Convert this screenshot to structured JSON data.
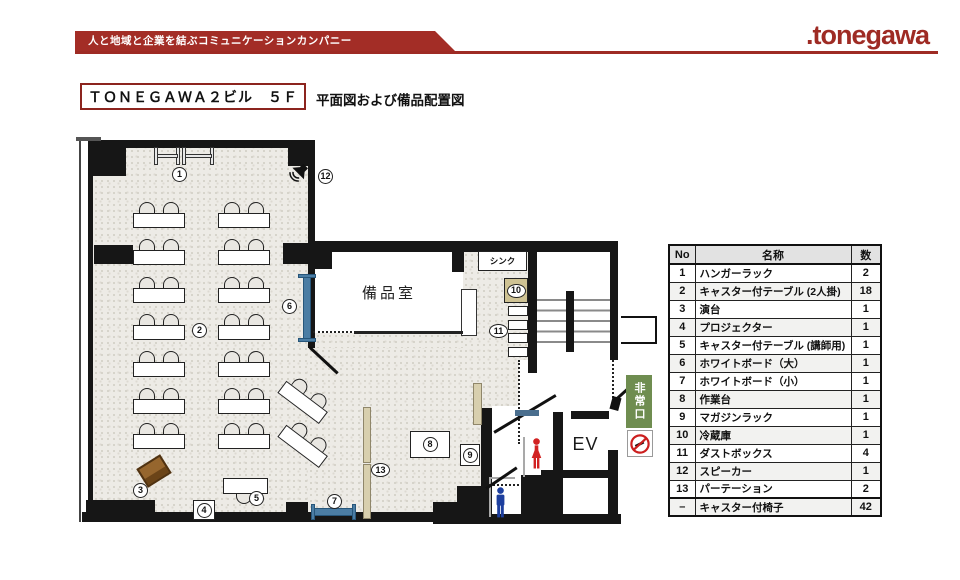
{
  "header": {
    "tagline": "人と地域と企業を結ぶコミュニケーションカンパニー",
    "logo": ".tonegawa"
  },
  "title": {
    "building": "ＴＯＮＥＧＡＷＡ２ビル　５Ｆ",
    "subtitle": "平面図および備品配置図"
  },
  "floorplan": {
    "rooms": {
      "storage": "備品室",
      "sink": "シンク",
      "elevator": "EV",
      "emergency_exit": "非常口"
    },
    "markers": [
      "1",
      "2",
      "3",
      "4",
      "5",
      "6",
      "7",
      "8",
      "9",
      "10",
      "11",
      "12",
      "13"
    ]
  },
  "equipment_table": {
    "headers": [
      "No",
      "名称",
      "数"
    ],
    "rows": [
      [
        "1",
        "ハンガーラック",
        "2"
      ],
      [
        "2",
        "キャスター付テーブル (2人掛)",
        "18"
      ],
      [
        "3",
        "演台",
        "1"
      ],
      [
        "4",
        "プロジェクター",
        "1"
      ],
      [
        "5",
        "キャスター付テーブル (講師用)",
        "1"
      ],
      [
        "6",
        "ホワイトボード（大）",
        "1"
      ],
      [
        "7",
        "ホワイトボード（小）",
        "1"
      ],
      [
        "8",
        "作業台",
        "1"
      ],
      [
        "9",
        "マガジンラック",
        "1"
      ],
      [
        "10",
        "冷蔵庫",
        "1"
      ],
      [
        "11",
        "ダストボックス",
        "4"
      ],
      [
        "12",
        "スピーカー",
        "1"
      ],
      [
        "13",
        "パーテーション",
        "2"
      ],
      [
        "–",
        "キャスター付椅子",
        "42"
      ]
    ]
  },
  "colors": {
    "brand_red": "#9e2b24",
    "wall_black": "#161616",
    "whiteboard_blue": "#4b7da4",
    "partition_tan": "#d8cfae",
    "lectern_brown": "#96662e",
    "exit_green": "#6f8d50",
    "women_red": "#d22222",
    "men_blue": "#1d3f9e"
  }
}
